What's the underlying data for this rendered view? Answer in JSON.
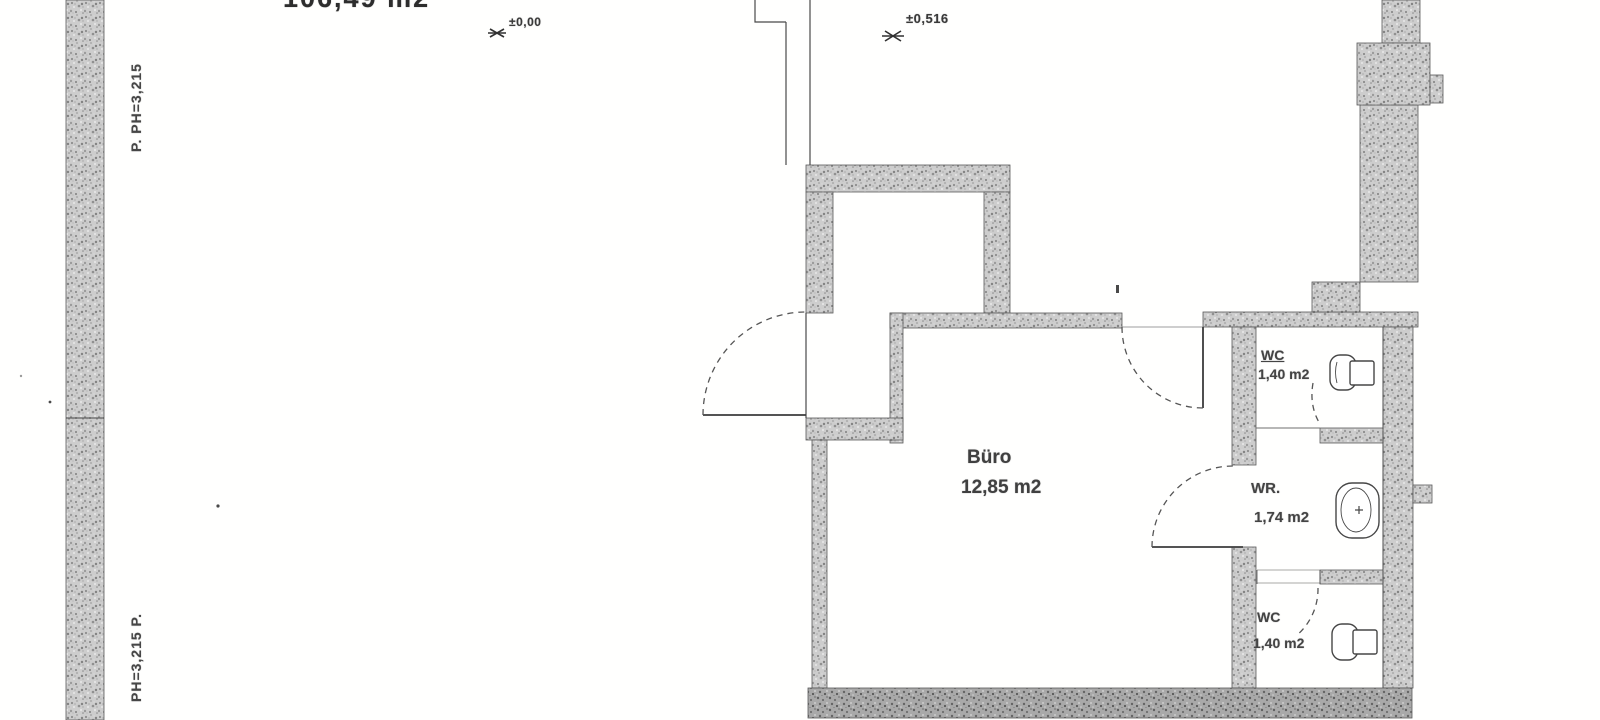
{
  "meta": {
    "background": "#fdfdfc",
    "wall_fill": "#cccccc",
    "wall_fill_dark": "#b0b0b0",
    "line_color": "#454545",
    "text_color": "#3a3a3a"
  },
  "annotations": {
    "area_total_partial": "106,49 m2",
    "level_marker_1": "±0,00",
    "level_marker_2": "±0,516",
    "parapet_label_top": "P. PH=3,215",
    "parapet_label_bottom": "PH=3,215  P."
  },
  "rooms": {
    "buero": {
      "name": "Büro",
      "area": "12,85 m2"
    },
    "wc_top": {
      "name": "WC",
      "area": "1,40 m2"
    },
    "wr": {
      "name": "WR.",
      "area": "1,74 m2"
    },
    "wc_bottom": {
      "name": "WC",
      "area": "1,40 m2"
    }
  }
}
